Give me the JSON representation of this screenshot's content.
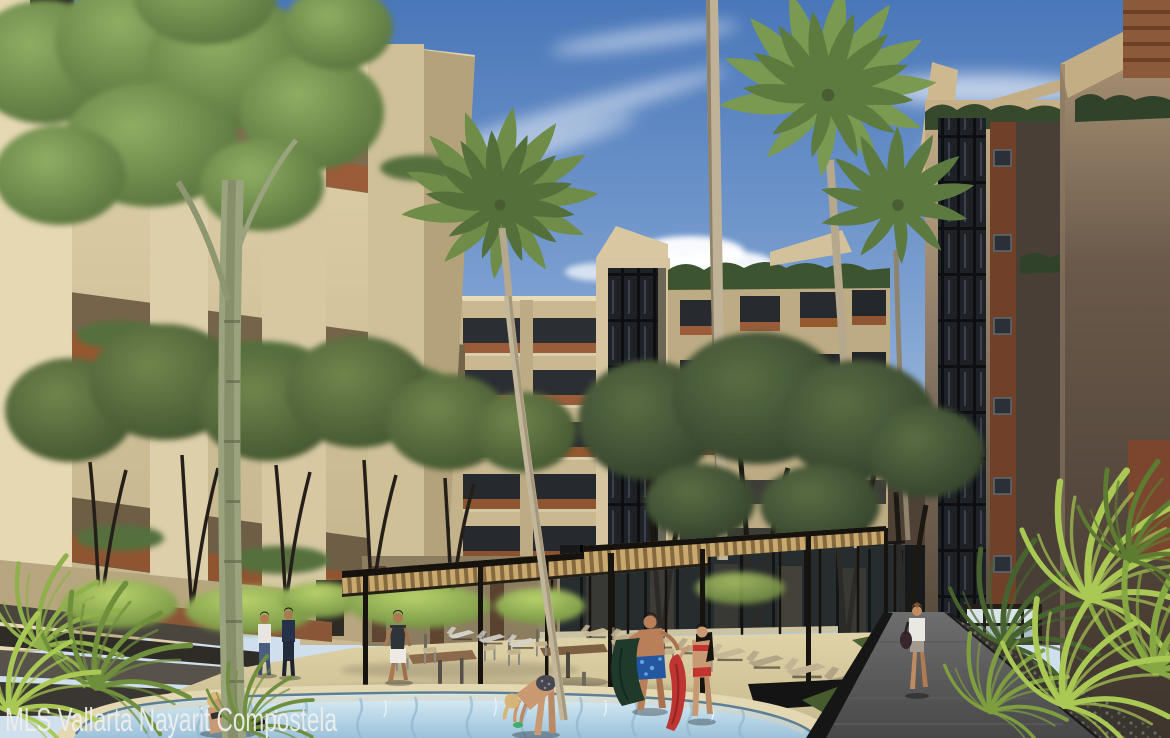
{
  "watermark": {
    "text": "MLS Vallarta Nayarit Compostela",
    "color": "#f1efec",
    "position": "bottom-left"
  },
  "scene": {
    "kind": "3d-architectural-rendering",
    "subject": "Courtyard pool amenity area of a multi-story resort apartment complex with palm trees",
    "time_of_day": "sunny afternoon",
    "buildings": {
      "left": "beige high-rise with brick balcony planters and hanging greenery",
      "center": "mid-rise with dark glass stair tower, brick balcony fronts and rooftop hedge",
      "right": "shaded taupe towers with full-height dark glazing strip, brick accent strip with small square windows, rooftop planting and lit ground-floor lounge"
    },
    "amenities": [
      "round foreground swimming pool with rippled water",
      "lap pool with black infinity edge and glass pool fence",
      "steel pergola with wood slat canopy over outdoor dining tables and chairs",
      "rows of chaise lounges",
      "stone walkway with black steel edging, gravel bed and grass strips",
      "terraced steps with low brick wall"
    ],
    "vegetation": [
      "tall coconut palms",
      "courtyard shade trees with forked dark trunks",
      "pale-bark tall tree rising through the frame at left",
      "bright tropical shrubs and ferns in planters"
    ],
    "people": [
      {
        "label": "man walking under pergola",
        "clothing": "dark tee, white shorts"
      },
      {
        "label": "man at pool edge holding dark green towel",
        "clothing": "blue floral swim trunks"
      },
      {
        "label": "woman at pool edge with red towel",
        "clothing": "red and white bikini, long dark hair"
      },
      {
        "label": "woman walking away on walkway",
        "clothing": "white top, gray shorts, dark shoulder bag"
      },
      {
        "label": "woman seated on pool deck",
        "clothing": "dark bikini, blonde"
      },
      {
        "label": "woman leaning over pool edge",
        "clothing": "gray polka-dot bikini, blonde"
      },
      {
        "label": "pair strolling on left terrace",
        "clothing": "white tee with jeans; dark outfit"
      }
    ],
    "palette": {
      "sky_top": "#4a77b9",
      "sky_mid": "#82a5d3",
      "sky_horizon": "#cfdfee",
      "cloud": "#ffffff",
      "beige_light": "#e3d5ae",
      "beige_mid": "#c9b890",
      "beige_shadow": "#a6966f",
      "brick": "#9a5c39",
      "brick_dark": "#74462c",
      "foliage_bright": "#8fae62",
      "foliage_olive": "#5d7340",
      "foliage_dark": "#3c4d2c",
      "palm_green": "#6f8c49",
      "trunk_pale": "#bfb296",
      "taupe_dark": "#544739",
      "glass_dark": "#1e2126",
      "pool_light": "#e2f1f6",
      "pool_deep": "#9cc2da",
      "lap_pool": "#6fa5c9",
      "sand_light": "#e0d3a8",
      "sand_shade": "#c6b78c",
      "path_gray": "#6e6e6e",
      "planter_black": "#161616",
      "grass": "#4d6233",
      "fern_bright": "#a9c854",
      "pergola_tan": "#c9a96d",
      "pergola_steel": "#17140f",
      "towel_green": "#1f3a2b",
      "towel_red": "#bf3531",
      "trunks_blue": "#2457a0"
    }
  }
}
